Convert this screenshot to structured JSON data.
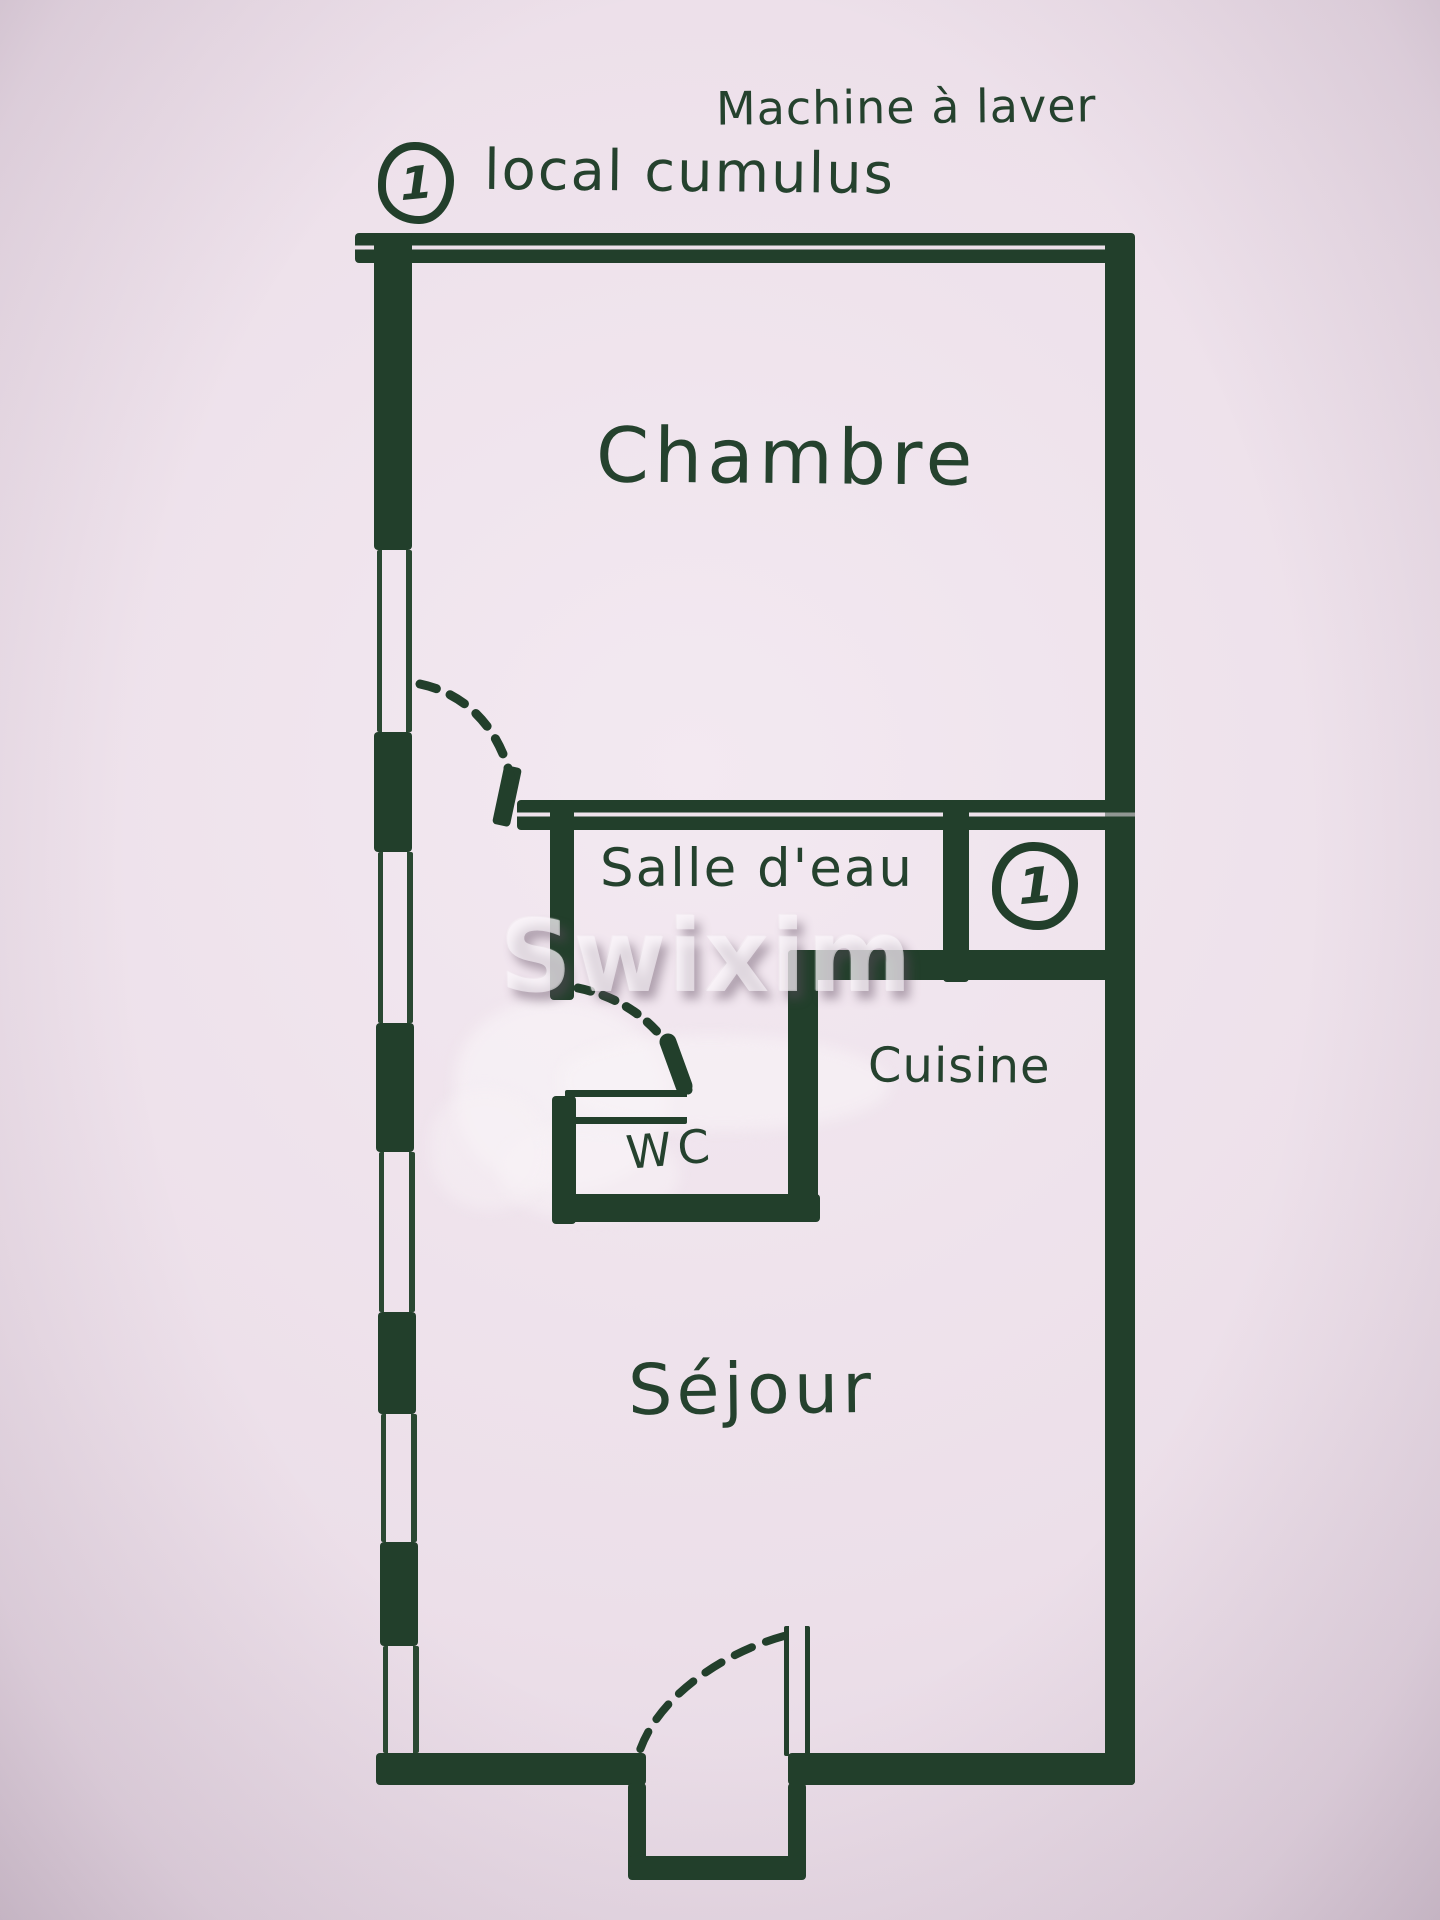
{
  "colors": {
    "ink": "#223f2b",
    "paper": "#ecdfe9",
    "watermark": "#faf5fa"
  },
  "watermark": {
    "text": "Swixim"
  },
  "annotations": {
    "machine_a_laver": "Machine à laver",
    "local_cumulus": "local cumulus",
    "unit_symbol": "1"
  },
  "rooms": {
    "chambre": "Chambre",
    "salle_deau": "Salle d'eau",
    "cuisine": "Cuisine",
    "wc": "WC",
    "sejour": "Séjour"
  }
}
